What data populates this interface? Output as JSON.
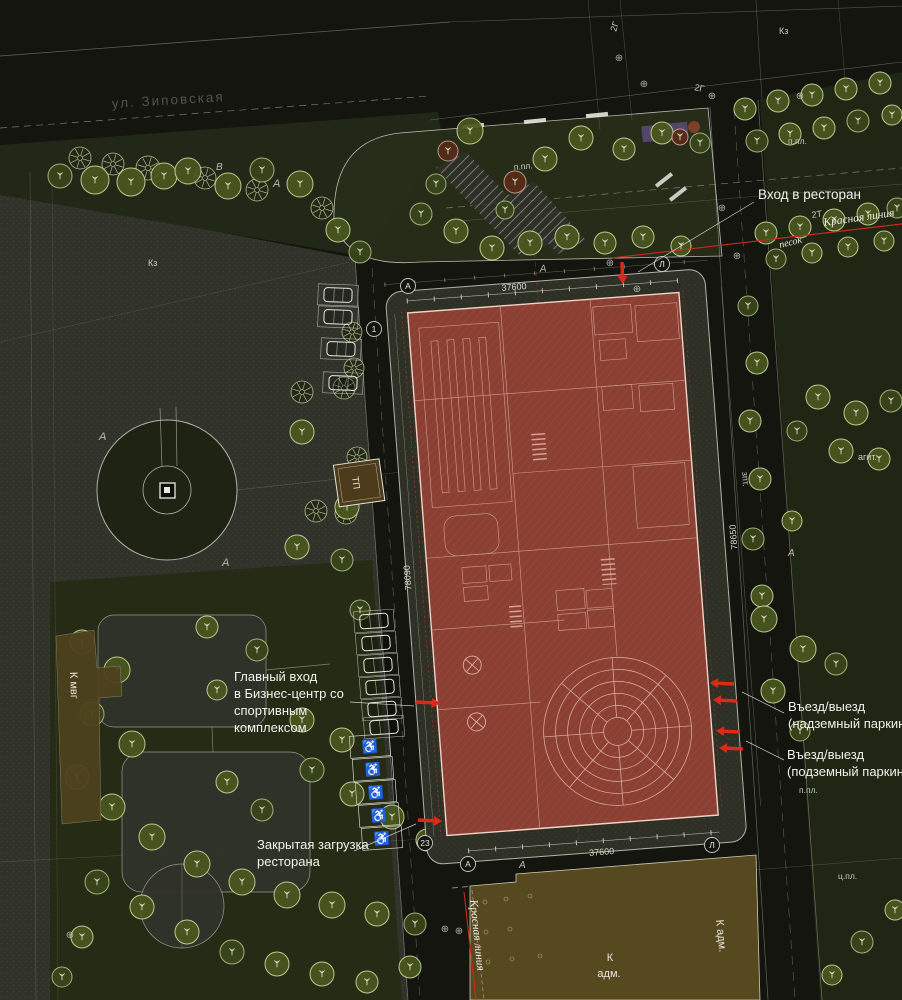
{
  "meta": {
    "drawing_type": "architectural site plan (genplan)",
    "language": "ru"
  },
  "colors": {
    "background": "#14150f",
    "plaza": "#31332b",
    "lawn": "#252b15",
    "verge": "#222817",
    "building_red": "#8c4034",
    "building_lines": "#d9a898",
    "admin_brown": "#57491f",
    "small_building_brown": "#4e421d",
    "accent_red": "#e02817",
    "red_line": "#c9281c",
    "tree_green": "#49571f",
    "text_white": "#f2f2ee",
    "text_gray": "#52544b"
  },
  "street": {
    "name": "ул. Зиповская"
  },
  "callouts": {
    "restaurant_entrance": "Вход в ресторан",
    "main_entrance_lines": [
      "Главный вход",
      "в Бизнес-центр со",
      "спортивным",
      "комплексом"
    ],
    "exit_surface_lines": [
      "Въезд/выезд",
      "(надземный паркинг)"
    ],
    "exit_underground_lines": [
      "Въезд/выезд",
      "(подземный паркинг)"
    ],
    "restaurant_loading_lines": [
      "Закрытая загрузка",
      "ресторана"
    ]
  },
  "red_lines": {
    "top": "Красная линия",
    "bottom": "Красная линия",
    "sand": "песок"
  },
  "buildings": {
    "admin": {
      "label_lines": [
        "К",
        "адм."
      ],
      "side_label": "К адм."
    },
    "mvg": {
      "label": "К мвг"
    },
    "transformer": {
      "label": "ТП"
    }
  },
  "dimensions": {
    "top": "37600",
    "bottom": "37600",
    "left": "78090",
    "right": "78650"
  },
  "axis_bubbles": [
    {
      "t": "А",
      "x": 408,
      "y": 286
    },
    {
      "t": "1",
      "x": 374,
      "y": 329
    },
    {
      "t": "Л",
      "x": 662,
      "y": 264
    },
    {
      "t": "А",
      "x": 468,
      "y": 864
    },
    {
      "t": "23",
      "x": 425,
      "y": 843
    },
    {
      "t": "Л",
      "x": 712,
      "y": 845
    }
  ],
  "small_labels": [
    {
      "t": "Кз",
      "x": 779,
      "y": 34,
      "r": 0,
      "s": 9,
      "k": "g"
    },
    {
      "t": "Кз",
      "x": 148,
      "y": 266,
      "r": 0,
      "s": 9,
      "k": "g"
    },
    {
      "t": "п.пл.",
      "x": 788,
      "y": 144,
      "r": 0,
      "s": 8.5,
      "k": "g"
    },
    {
      "t": "п.пл.",
      "x": 514,
      "y": 170,
      "r": -5,
      "s": 8.5,
      "k": "g"
    },
    {
      "t": "п.пл.",
      "x": 799,
      "y": 793,
      "r": 0,
      "s": 8.5,
      "k": "g"
    },
    {
      "t": "ц.пл.",
      "x": 838,
      "y": 879,
      "r": 0,
      "s": 8.5,
      "k": "g"
    },
    {
      "t": "2Г",
      "x": 616,
      "y": 32,
      "r": -72,
      "s": 9,
      "k": "g"
    },
    {
      "t": "2Г",
      "x": 694,
      "y": 90,
      "r": 12,
      "s": 9,
      "k": "g"
    },
    {
      "t": "2Т",
      "x": 812,
      "y": 218,
      "r": -8,
      "s": 9,
      "k": "g"
    },
    {
      "t": "зпт.",
      "x": 742,
      "y": 472,
      "r": 86,
      "s": 9,
      "k": "g"
    },
    {
      "t": "агит.",
      "x": 858,
      "y": 460,
      "r": 0,
      "s": 9,
      "k": "g"
    },
    {
      "t": "ТП",
      "x": 352,
      "y": 477,
      "r": 82,
      "s": 9.5,
      "k": "w"
    },
    {
      "t": "А",
      "x": 273,
      "y": 187,
      "r": 0,
      "s": 11,
      "k": "i"
    },
    {
      "t": "В",
      "x": 216,
      "y": 170,
      "r": 0,
      "s": 10,
      "k": "i"
    },
    {
      "t": "А",
      "x": 99,
      "y": 440,
      "r": 0,
      "s": 11,
      "k": "i"
    },
    {
      "t": "А",
      "x": 222,
      "y": 566,
      "r": 0,
      "s": 11,
      "k": "i"
    },
    {
      "t": "А",
      "x": 519,
      "y": 868,
      "r": 0,
      "s": 10,
      "k": "i"
    },
    {
      "t": "А",
      "x": 788,
      "y": 556,
      "r": 0,
      "s": 10,
      "k": "i"
    },
    {
      "t": "А",
      "x": 540,
      "y": 272,
      "r": -5,
      "s": 10,
      "k": "i"
    }
  ],
  "icons": {
    "wheelchair": "♿",
    "survey_marker": "⊕"
  },
  "decor": {
    "trees": [
      [
        80,
        158,
        11,
        "star"
      ],
      [
        113,
        164,
        11,
        "star"
      ],
      [
        148,
        168,
        12,
        "star"
      ],
      [
        205,
        178,
        11,
        "star"
      ],
      [
        257,
        190,
        11,
        "star"
      ],
      [
        322,
        208,
        11,
        "star"
      ],
      [
        95,
        180,
        14,
        "leaf"
      ],
      [
        131,
        182,
        14,
        "leaf"
      ],
      [
        164,
        176,
        13,
        "leaf"
      ],
      [
        188,
        171,
        13,
        "leaf"
      ],
      [
        228,
        186,
        13,
        "leaf"
      ],
      [
        262,
        170,
        12,
        "leaf2"
      ],
      [
        300,
        184,
        13,
        "leaf"
      ],
      [
        338,
        230,
        12,
        "leaf"
      ],
      [
        360,
        252,
        11,
        "leaf2"
      ],
      [
        60,
        176,
        12,
        "leaf2"
      ],
      [
        352,
        332,
        10,
        "star"
      ],
      [
        354,
        368,
        10,
        "star"
      ],
      [
        316,
        511,
        11,
        "star"
      ],
      [
        346,
        513,
        11,
        "star"
      ],
      [
        470,
        131,
        13,
        "leaf"
      ],
      [
        545,
        159,
        12,
        "leaf"
      ],
      [
        581,
        138,
        12,
        "leaf"
      ],
      [
        624,
        149,
        11,
        "leaf"
      ],
      [
        662,
        133,
        11,
        "leaf"
      ],
      [
        700,
        143,
        10,
        "leaf2"
      ],
      [
        448,
        151,
        10,
        "red"
      ],
      [
        515,
        182,
        11,
        "red"
      ],
      [
        680,
        137,
        8,
        "red"
      ],
      [
        421,
        214,
        11,
        "leaf2"
      ],
      [
        456,
        231,
        12,
        "leaf"
      ],
      [
        492,
        248,
        12,
        "leaf"
      ],
      [
        530,
        243,
        12,
        "leaf"
      ],
      [
        567,
        237,
        12,
        "leaf"
      ],
      [
        605,
        243,
        11,
        "leaf"
      ],
      [
        643,
        237,
        11,
        "leaf"
      ],
      [
        681,
        246,
        10,
        "leaf"
      ],
      [
        436,
        184,
        10,
        "leaf2"
      ],
      [
        505,
        210,
        9,
        "leaf2"
      ],
      [
        745,
        109,
        11,
        "leaf"
      ],
      [
        778,
        101,
        11,
        "leaf"
      ],
      [
        812,
        95,
        11,
        "leaf"
      ],
      [
        846,
        89,
        11,
        "leaf"
      ],
      [
        880,
        83,
        11,
        "leaf"
      ],
      [
        757,
        141,
        11,
        "leaf2"
      ],
      [
        790,
        134,
        11,
        "leaf"
      ],
      [
        824,
        128,
        11,
        "leaf"
      ],
      [
        858,
        121,
        11,
        "leaf2"
      ],
      [
        892,
        115,
        10,
        "leaf"
      ],
      [
        766,
        233,
        11,
        "leaf"
      ],
      [
        800,
        227,
        11,
        "leaf"
      ],
      [
        834,
        220,
        11,
        "leaf"
      ],
      [
        868,
        214,
        11,
        "leaf"
      ],
      [
        897,
        208,
        10,
        "leaf2"
      ],
      [
        776,
        259,
        10,
        "leaf2"
      ],
      [
        812,
        253,
        10,
        "leaf"
      ],
      [
        848,
        247,
        10,
        "leaf"
      ],
      [
        884,
        241,
        10,
        "leaf"
      ],
      [
        748,
        306,
        10,
        "leaf2"
      ],
      [
        757,
        363,
        11,
        "leaf"
      ],
      [
        750,
        421,
        11,
        "leaf"
      ],
      [
        760,
        479,
        11,
        "leaf"
      ],
      [
        753,
        539,
        11,
        "leaf2"
      ],
      [
        792,
        521,
        10,
        "leaf"
      ],
      [
        762,
        596,
        11,
        "leaf"
      ],
      [
        818,
        397,
        12,
        "leaf"
      ],
      [
        856,
        413,
        12,
        "leaf"
      ],
      [
        891,
        401,
        11,
        "leaf2"
      ],
      [
        841,
        451,
        12,
        "leaf"
      ],
      [
        879,
        459,
        11,
        "leaf"
      ],
      [
        797,
        431,
        10,
        "leaf2"
      ],
      [
        764,
        619,
        13,
        "leaf"
      ],
      [
        803,
        649,
        13,
        "leaf"
      ],
      [
        773,
        691,
        12,
        "leaf"
      ],
      [
        836,
        664,
        11,
        "leaf2"
      ],
      [
        800,
        731,
        10,
        "leaf2"
      ],
      [
        82,
        642,
        12,
        "leaf"
      ],
      [
        117,
        670,
        13,
        "leaf"
      ],
      [
        92,
        714,
        12,
        "leaf2"
      ],
      [
        132,
        744,
        13,
        "leaf"
      ],
      [
        77,
        777,
        12,
        "leaf"
      ],
      [
        112,
        807,
        13,
        "leaf"
      ],
      [
        152,
        837,
        13,
        "leaf"
      ],
      [
        197,
        864,
        13,
        "leaf"
      ],
      [
        242,
        882,
        13,
        "leaf"
      ],
      [
        287,
        895,
        13,
        "leaf"
      ],
      [
        332,
        905,
        13,
        "leaf"
      ],
      [
        377,
        914,
        12,
        "leaf"
      ],
      [
        415,
        924,
        11,
        "leaf2"
      ],
      [
        97,
        882,
        12,
        "leaf2"
      ],
      [
        142,
        907,
        12,
        "leaf"
      ],
      [
        187,
        932,
        12,
        "leaf"
      ],
      [
        232,
        952,
        12,
        "leaf2"
      ],
      [
        277,
        964,
        12,
        "leaf"
      ],
      [
        322,
        974,
        12,
        "leaf"
      ],
      [
        367,
        982,
        11,
        "leaf"
      ],
      [
        82,
        937,
        11,
        "leaf"
      ],
      [
        62,
        977,
        10,
        "leaf2"
      ],
      [
        410,
        967,
        11,
        "leaf"
      ],
      [
        302,
        720,
        12,
        "leaf"
      ],
      [
        342,
        740,
        12,
        "leaf"
      ],
      [
        312,
        770,
        12,
        "leaf2"
      ],
      [
        352,
        794,
        12,
        "leaf"
      ],
      [
        392,
        817,
        12,
        "leaf"
      ],
      [
        427,
        840,
        11,
        "leaf"
      ],
      [
        262,
        810,
        11,
        "leaf2"
      ],
      [
        227,
        782,
        11,
        "leaf"
      ],
      [
        207,
        627,
        11,
        "leaf"
      ],
      [
        257,
        650,
        11,
        "leaf2"
      ],
      [
        217,
        690,
        10,
        "leaf"
      ],
      [
        302,
        392,
        11,
        "star"
      ],
      [
        344,
        388,
        11,
        "star"
      ],
      [
        357,
        457,
        10,
        "star"
      ],
      [
        302,
        432,
        12,
        "leaf"
      ],
      [
        347,
        507,
        12,
        "leaf"
      ],
      [
        297,
        547,
        12,
        "leaf"
      ],
      [
        342,
        560,
        11,
        "leaf2"
      ],
      [
        360,
        610,
        10,
        "leaf2"
      ],
      [
        862,
        942,
        11,
        "leaf2"
      ],
      [
        895,
        910,
        10,
        "leaf"
      ],
      [
        832,
        975,
        10,
        "leaf"
      ]
    ],
    "car_stalls": [
      [
        338,
        295,
        2
      ],
      [
        338,
        317,
        2
      ],
      [
        341,
        349,
        2
      ],
      [
        343,
        383,
        2
      ],
      [
        374,
        621,
        -4
      ],
      [
        376,
        643,
        -4
      ],
      [
        378,
        665,
        -4
      ],
      [
        380,
        687,
        -4
      ],
      [
        382,
        709,
        -4
      ],
      [
        384,
        727,
        -4
      ]
    ],
    "disabled_stalls": [
      [
        370,
        746,
        -4
      ],
      [
        373,
        769,
        -4
      ],
      [
        376,
        792,
        -4
      ],
      [
        379,
        815,
        -4
      ],
      [
        382,
        838,
        -4
      ]
    ],
    "arrows": [
      [
        622,
        262,
        88,
        22
      ],
      [
        416,
        702,
        3,
        24
      ],
      [
        418,
        820,
        3,
        24
      ],
      [
        734,
        684,
        183,
        24
      ],
      [
        737,
        701,
        183,
        24
      ],
      [
        740,
        732,
        183,
        24
      ],
      [
        743,
        749,
        183,
        24
      ]
    ],
    "survey_markers": [
      [
        722,
        211
      ],
      [
        737,
        259
      ],
      [
        619,
        61
      ],
      [
        644,
        87
      ],
      [
        712,
        99
      ],
      [
        800,
        99
      ],
      [
        610,
        266
      ],
      [
        637,
        292
      ],
      [
        445,
        932
      ],
      [
        459,
        934
      ],
      [
        70,
        938
      ]
    ]
  }
}
